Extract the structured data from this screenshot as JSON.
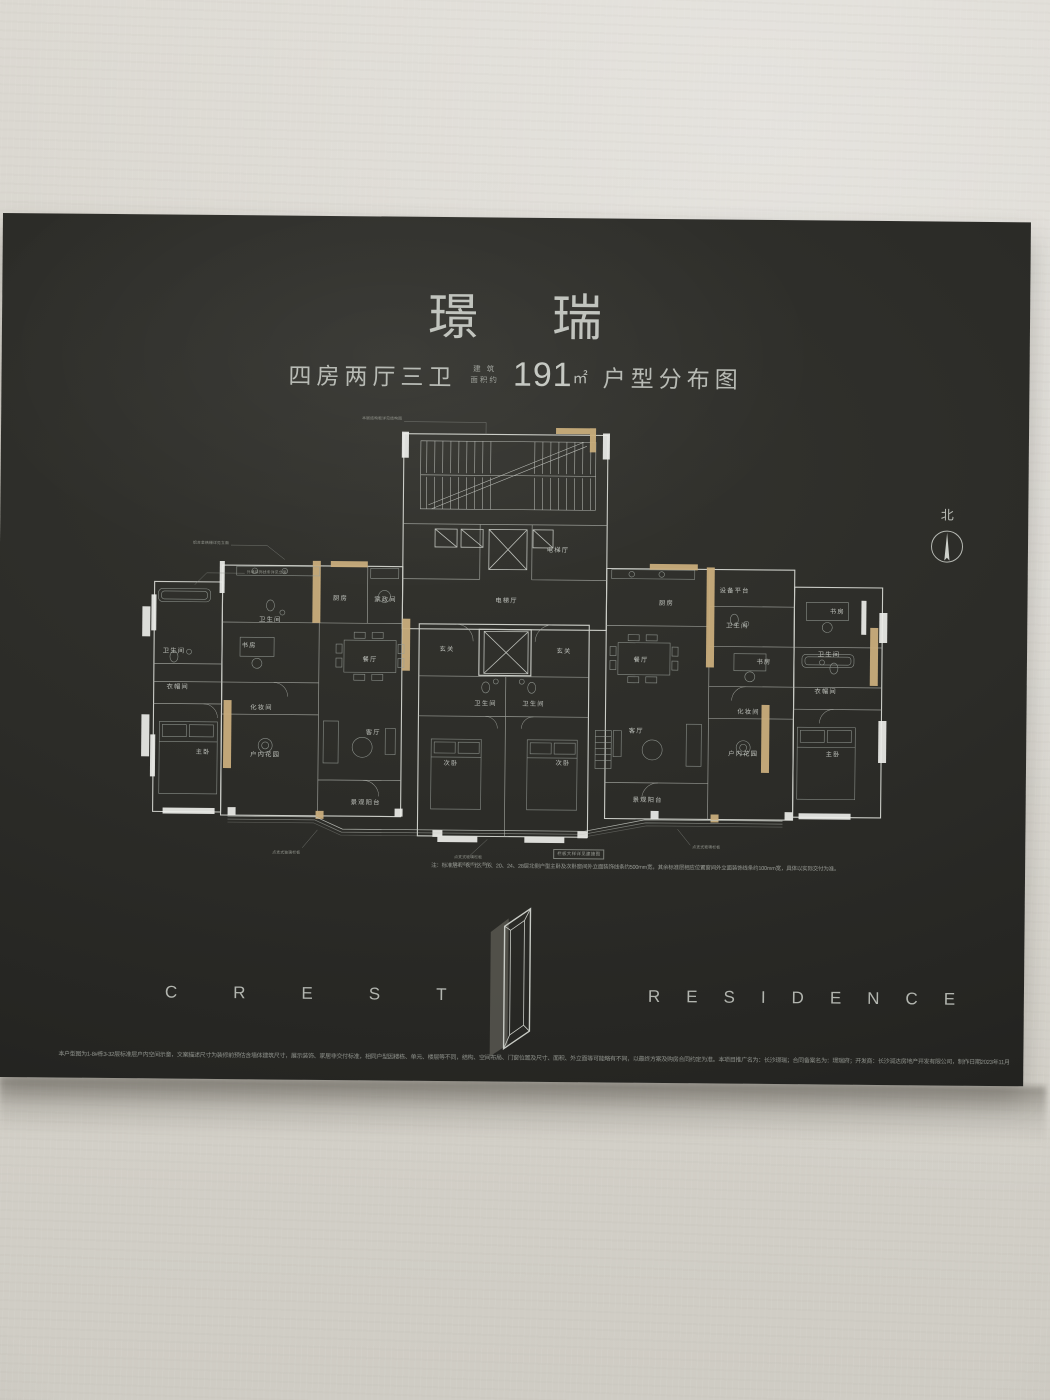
{
  "board": {
    "title": "璟 瑞",
    "subtitle": {
      "layout": "四房两厅三卫",
      "area_prefix1": "建 筑",
      "area_prefix2": "面积约",
      "area_value": "191",
      "area_unit": "㎡",
      "suffix": "户型分布图"
    },
    "north_label": "北",
    "note_box": "栏板大样详见建施图",
    "note": "注：标准层4、8、12、16、20、24、28层北侧户型主卧及次卧窗间外立面装饰线条约500mm宽，其余标准层相应位置窗间外立面装饰线条约100mm宽，具体以实际交付为准。",
    "logo": {
      "left": "CREST",
      "right": "RESIDENCE"
    },
    "disclaimer": "本户型图为1-8#栋3-32层标准层户内空间示意，文案描述尺寸为装修前预估含墙体建筑尺寸，展示装饰、家居非交付标准，相同户型因楼栋、单元、楼层等不同，结构、空间布局、门窗位置及尺寸、面积、外立面等可能略有不同，以最终方案及购房合同约定为准。本项目推广名为：长沙璟瑞；合同备案名为：璟瑞府；开发商：长沙润达房地产开发有限公司，制作日期2023年11月"
  },
  "floorplan": {
    "rooms": [
      {
        "label": "电梯厅",
        "x": 423,
        "y": 152
      },
      {
        "label": "电梯厅",
        "x": 372,
        "y": 203
      },
      {
        "label": "厨房",
        "x": 206,
        "y": 202
      },
      {
        "label": "家政间",
        "x": 251,
        "y": 203
      },
      {
        "label": "餐厅",
        "x": 236,
        "y": 263
      },
      {
        "label": "卫生间",
        "x": 40,
        "y": 256
      },
      {
        "label": "书房",
        "x": 115,
        "y": 250
      },
      {
        "label": "卫生间",
        "x": 136,
        "y": 224
      },
      {
        "label": "衣帽间",
        "x": 44,
        "y": 292
      },
      {
        "label": "化妆间",
        "x": 128,
        "y": 312
      },
      {
        "label": "主卧",
        "x": 70,
        "y": 357
      },
      {
        "label": "户内花园",
        "x": 132,
        "y": 359
      },
      {
        "label": "客厅",
        "x": 240,
        "y": 336
      },
      {
        "label": "景观阳台",
        "x": 233,
        "y": 406
      },
      {
        "label": "玄关",
        "x": 313,
        "y": 252
      },
      {
        "label": "玄关",
        "x": 430,
        "y": 253
      },
      {
        "label": "卫生间",
        "x": 352,
        "y": 306
      },
      {
        "label": "卫生间",
        "x": 400,
        "y": 306
      },
      {
        "label": "次卧",
        "x": 318,
        "y": 366
      },
      {
        "label": "次卧",
        "x": 430,
        "y": 365
      },
      {
        "label": "餐厅",
        "x": 507,
        "y": 261
      },
      {
        "label": "客厅",
        "x": 503,
        "y": 332
      },
      {
        "label": "厨房",
        "x": 532,
        "y": 204
      },
      {
        "label": "设备平台",
        "x": 600,
        "y": 191
      },
      {
        "label": "卫生间",
        "x": 603,
        "y": 226
      },
      {
        "label": "书房",
        "x": 630,
        "y": 262
      },
      {
        "label": "书房",
        "x": 703,
        "y": 211
      },
      {
        "label": "卫生间",
        "x": 695,
        "y": 254
      },
      {
        "label": "衣帽间",
        "x": 692,
        "y": 291
      },
      {
        "label": "化妆间",
        "x": 615,
        "y": 312
      },
      {
        "label": "户内花园",
        "x": 610,
        "y": 354
      },
      {
        "label": "主卧",
        "x": 700,
        "y": 354
      },
      {
        "label": "景观阳台",
        "x": 515,
        "y": 401
      }
    ],
    "annotations": [
      {
        "text": "铝合金格栅详见立面",
        "x": 94,
        "y": 147,
        "anchor": "end"
      },
      {
        "text": "外墙装饰线条详见立面",
        "x": 112,
        "y": 176,
        "anchor": "start"
      },
      {
        "text": "本层结构板详见结构图",
        "x": 266,
        "y": 21,
        "anchor": "end"
      },
      {
        "text": "点支式玻璃栏板",
        "x": 168,
        "y": 456,
        "anchor": "end"
      },
      {
        "text": "点支式玻璃栏板",
        "x": 322,
        "y": 459,
        "anchor": "start"
      },
      {
        "text": "（上层结构线以上部分）",
        "x": 318,
        "y": 466,
        "anchor": "start"
      },
      {
        "text": "点支式玻璃栏板",
        "x": 560,
        "y": 447,
        "anchor": "start"
      }
    ]
  },
  "colors": {
    "wall": "#d8d5ce",
    "board": "#2b2b27",
    "plan_line": "#d9dbd5",
    "accent_tan": "#c9ad7c",
    "text_gray": "#b8bbb5"
  }
}
